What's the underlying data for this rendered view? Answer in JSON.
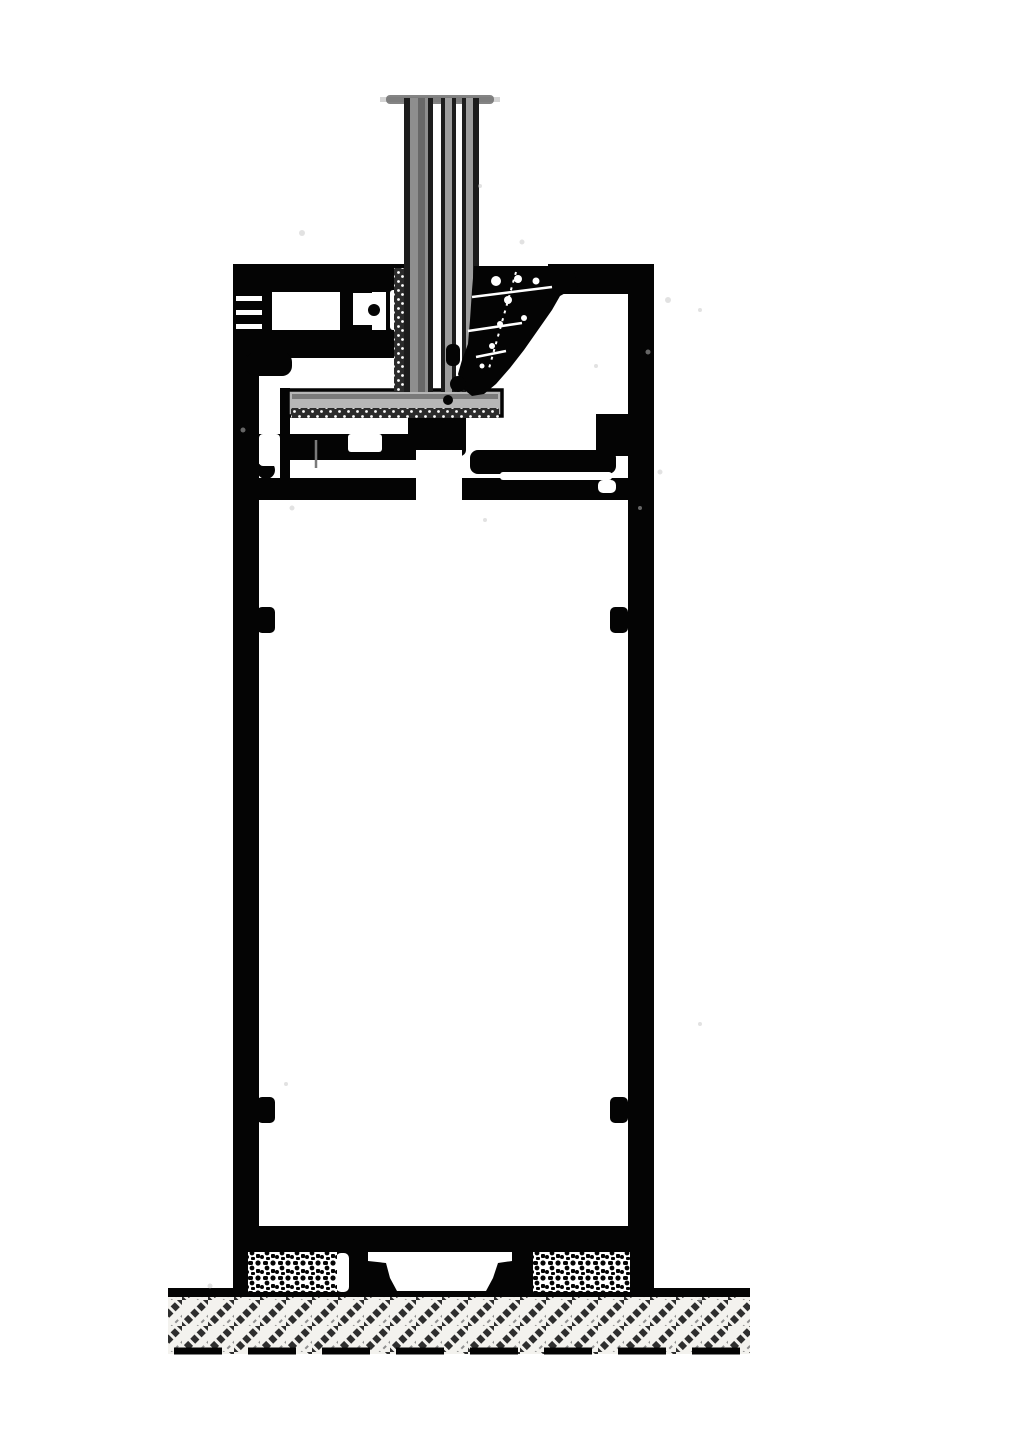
{
  "drawing": {
    "kind": "technical-section-detail",
    "components": {
      "glass_unit": "insulated-glazing-unit",
      "break_line": "glass-cut-break-line",
      "glazing_bead": "glazing-bead-with-screw-channel",
      "wedge_gasket": "wedge-gasket-with-screw",
      "setting_block": "glass-setting-block",
      "mullion_box": "hollow-box-profile",
      "screw_bosses": "internal-screw-boss-tabs",
      "foam_seals": "compressible-foam-seals",
      "shim": "levelling-shim",
      "floor_slab": "hatched-floor-substrate"
    }
  },
  "colors": {
    "paper": "#ffffff",
    "ink": "#040404",
    "glass_edge": "#1c1c1c",
    "glass_mid": "#8e8e8e",
    "glass_core": "#686868",
    "glass_light": "#9d9d9d",
    "break_line": "#6f6f6f",
    "break_halo": "#b9b9b9",
    "setting_block": "#b6b6b6",
    "block_shadow": "#7a7a7a",
    "gasket_dark": "#2b2b2b",
    "hatch_line": "#2e2e2e",
    "hatch_faint": "#8f8f8f",
    "hatch_bg": "#f3f2ee",
    "detail_line": "#7a7a7a",
    "noise": "#c6c6c6"
  }
}
